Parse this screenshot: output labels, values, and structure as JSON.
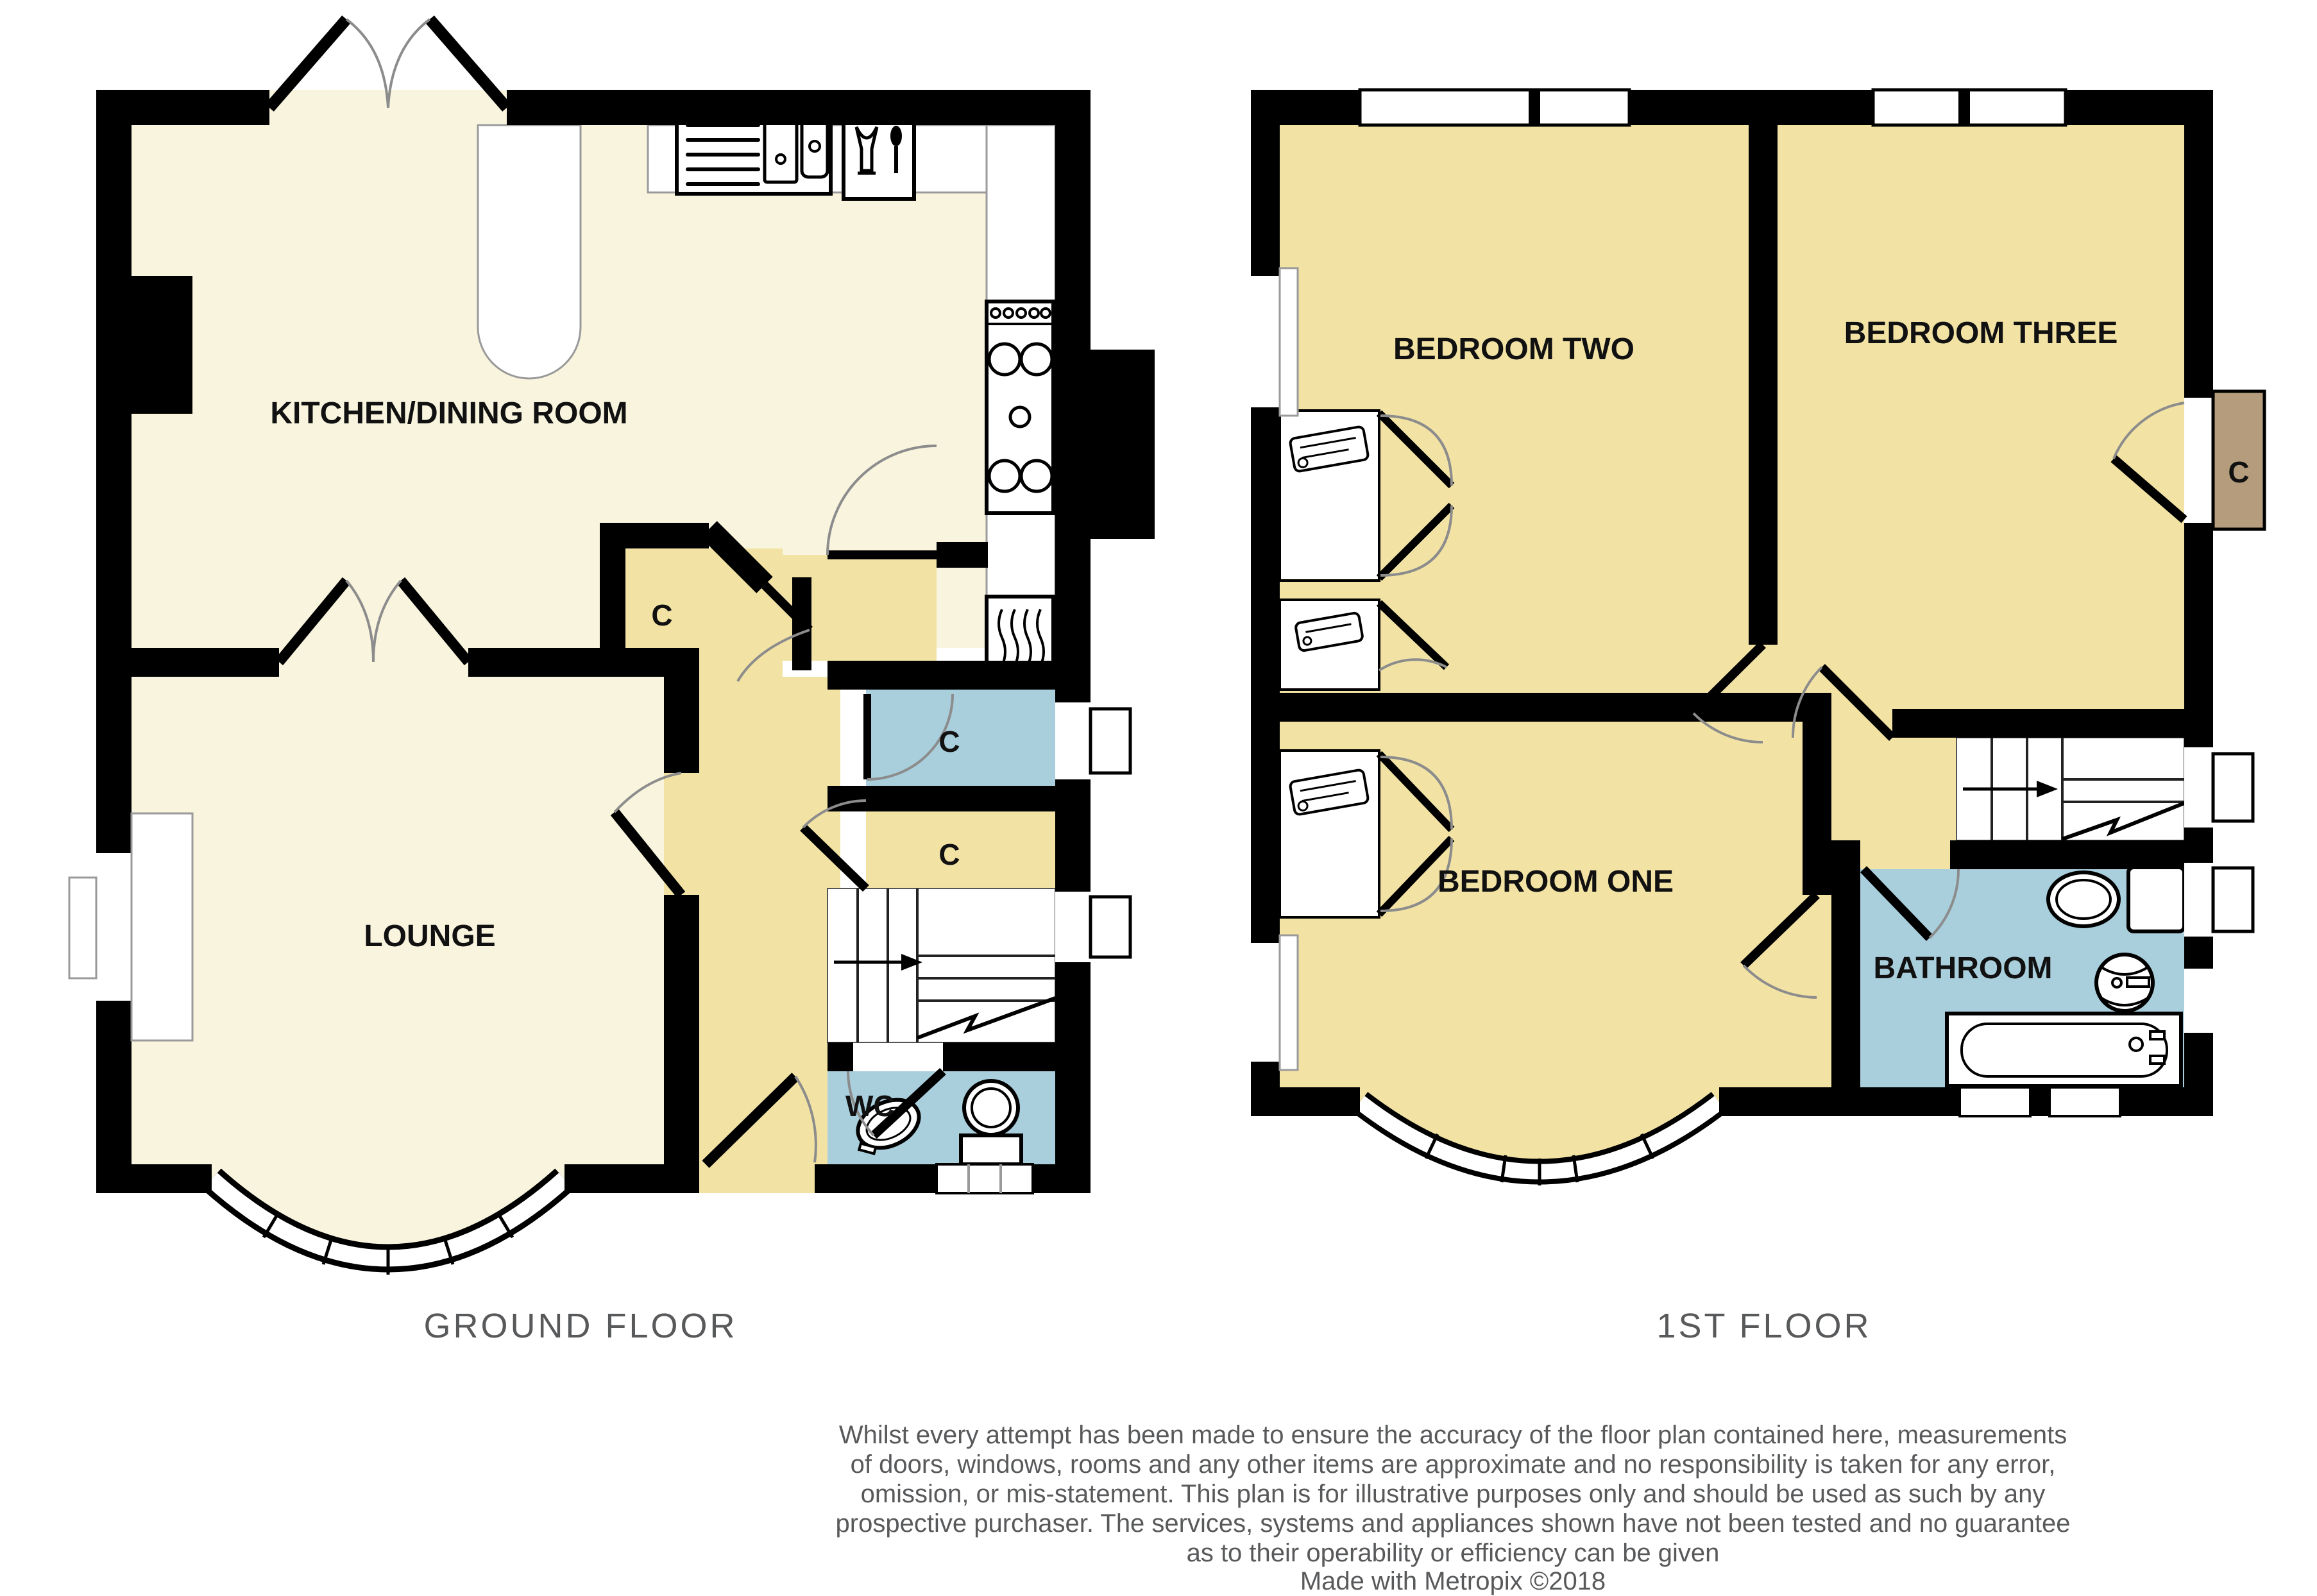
{
  "ground_floor": {
    "title": "GROUND FLOOR",
    "rooms": {
      "kitchen": "KITCHEN/DINING ROOM",
      "lounge": "LOUNGE",
      "wc": "WC"
    },
    "cupboard_label": "C"
  },
  "first_floor": {
    "title": "1ST FLOOR",
    "rooms": {
      "bedroom_two": "BEDROOM TWO",
      "bedroom_three": "BEDROOM THREE",
      "bedroom_one": "BEDROOM ONE",
      "bathroom": "BATHROOM"
    },
    "cupboard_label": "C"
  },
  "disclaimer": {
    "lines": [
      "Whilst every attempt has been made to ensure the accuracy of the floor plan contained here, measurements",
      "of doors, windows, rooms and any other items are approximate and no responsibility is taken for any error,",
      "omission, or mis-statement. This plan is for illustrative purposes only and should be used as such by any",
      "prospective purchaser. The services, systems and appliances shown have not been tested and no guarantee",
      "as to their operability or efficiency can be given",
      "Made with Metropix ©2018"
    ]
  },
  "colors": {
    "wall": "#000000",
    "kitchen_lounge_floor": "#F8F4DE",
    "hall_bedroom_floor": "#F2E3A5",
    "wet_room_floor": "#A9CEDC",
    "cupboard_brown": "#B59C7C",
    "title_gray": "#58595B"
  }
}
